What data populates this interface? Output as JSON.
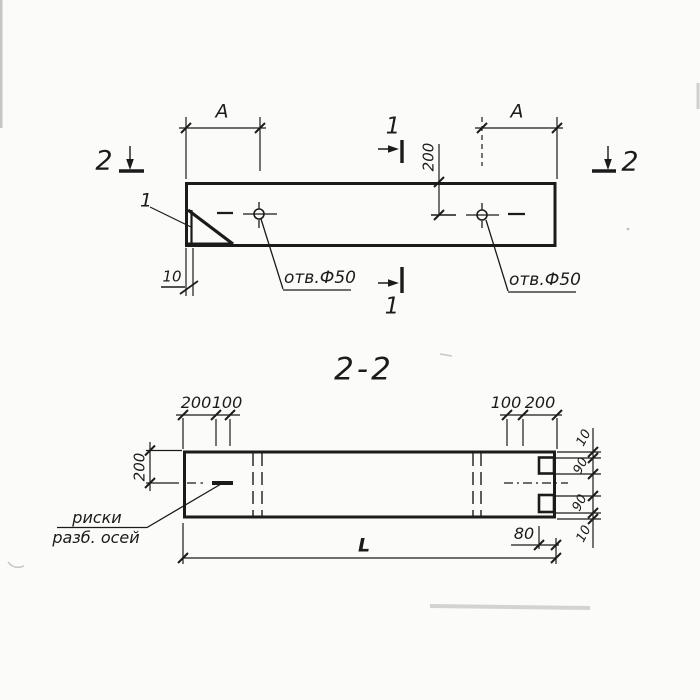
{
  "title": "2-2",
  "colors": {
    "ink": "#1b1b1b",
    "paper": "#fbfbf9"
  },
  "top_view": {
    "dim_a_left": "A",
    "dim_a_right": "A",
    "dim_depth": "200",
    "dim_wall": "10",
    "detail_mark": "1",
    "hole_note_left": "отв.Ф50",
    "hole_note_right": "отв.Ф50",
    "section_left": "2",
    "section_right": "2",
    "section_top": "1",
    "section_bottom": "1"
  },
  "section_view": {
    "dims_top_left": [
      "200",
      "100"
    ],
    "dims_top_right": [
      "100",
      "200"
    ],
    "dim_height": "200",
    "dims_right": [
      "10",
      "90",
      "90",
      "10"
    ],
    "dim_notch": "80",
    "dim_length": "L",
    "axis_note": [
      "риски",
      "разб. осей"
    ]
  }
}
